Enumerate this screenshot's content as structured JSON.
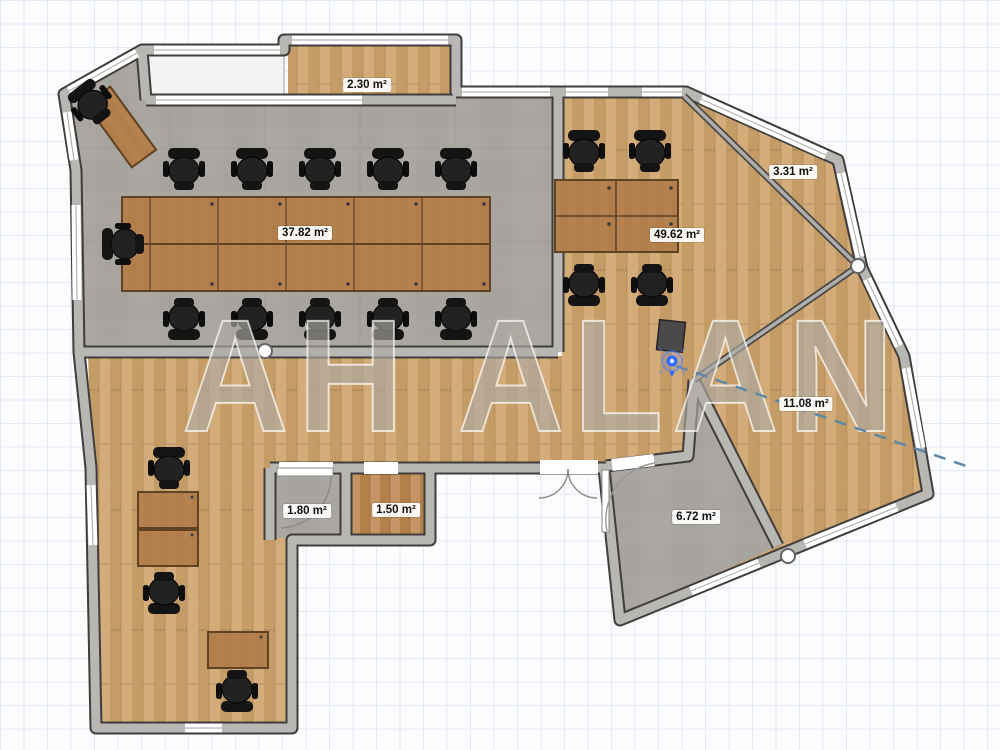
{
  "app": {
    "view": "floor-plan-2d"
  },
  "watermark": "AH ALAN",
  "units": "m²",
  "rooms": [
    {
      "id": "balcony",
      "area_label": "2.30 m²"
    },
    {
      "id": "meeting-room",
      "area_label": "37.82 m²"
    },
    {
      "id": "open-office",
      "area_label": "49.62 m²"
    },
    {
      "id": "corner-nook",
      "area_label": "3.31 m²"
    },
    {
      "id": "right-wing",
      "area_label": "11.08 m²"
    },
    {
      "id": "wc",
      "area_label": "1.80 m²"
    },
    {
      "id": "storage",
      "area_label": "1.50 m²"
    },
    {
      "id": "entry-room",
      "area_label": "6.72 m²"
    }
  ],
  "icons": {
    "location_marker": "location-marker-icon",
    "wall_handle": "wall-handle-icon"
  },
  "colors": {
    "wood_floor": "#cda571",
    "dark_wood_floor": "#bd8a57",
    "concrete_floor": "#a9a5a0",
    "wall_light": "#b9b7b4",
    "wall_dark": "#3f3e3c",
    "desk_wood": "#b5824f",
    "chair": "#1c1c1c",
    "accent_blue": "#2f6bff",
    "dash_line": "#5f87a8",
    "watermark_gray": "#7d786e"
  }
}
